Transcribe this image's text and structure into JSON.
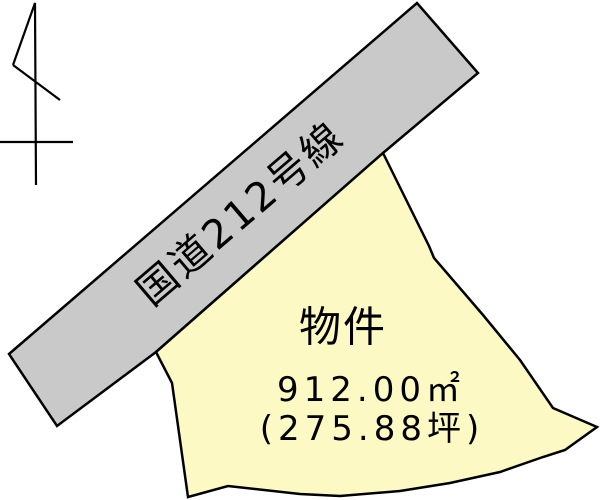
{
  "canvas": {
    "width": 600,
    "height": 500,
    "background_color": "#ffffff",
    "outline_color": "#000000"
  },
  "road": {
    "label": "国道212号線",
    "fill": "#c9c9c9",
    "points": "9,354 417,3 478,73 383,153 156,352 57,426"
  },
  "parcel": {
    "label": "物件",
    "area_m2": "912.00㎡",
    "area_tsubo": "(275.88坪)",
    "fill": "#fcf9c4",
    "points": "383,153 429,246 434,258 483,315 520,360 553,408 597,427 565,450 543,457 500,472 450,483 400,491 340,496 300,494 228,486 188,497 172,383 156,352"
  },
  "north_arrow": {
    "color": "#000000",
    "mast_points": "13,65 35,3 36,185",
    "tail_points": "13,65 60,100",
    "crossbar_points": "0,142 73,142"
  }
}
